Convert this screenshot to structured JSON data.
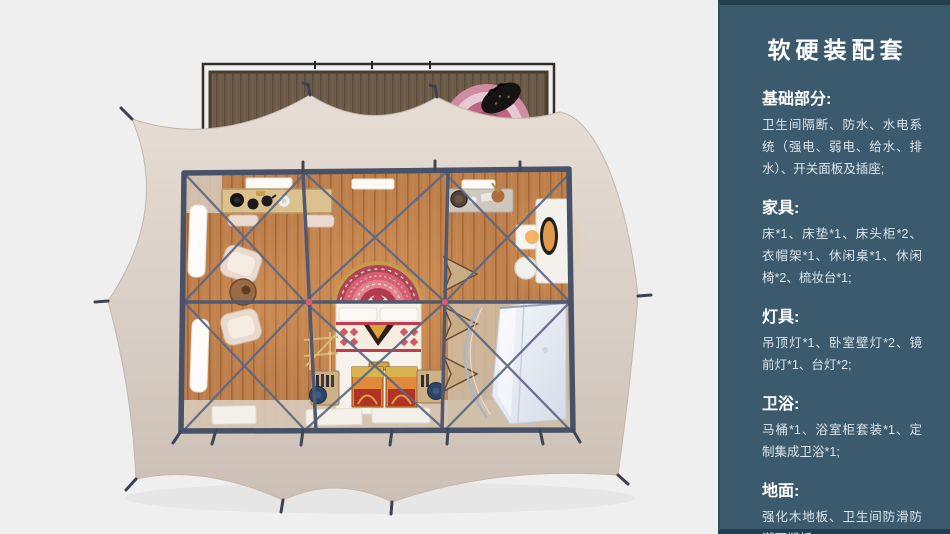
{
  "page": {
    "background": "#efeff0"
  },
  "sidebar": {
    "title": "软硬装配套",
    "sections": [
      {
        "heading": "基础部分:",
        "body": "卫生间隔断、防水、水电系统（强电、弱电、给水、排水）、开关面板及插座;"
      },
      {
        "heading": "家具:",
        "body": "床*1、床垫*1、床头柜*2、衣帽架*1、休闲桌*1、休闲椅*2、梳妆台*1;"
      },
      {
        "heading": "灯具:",
        "body": "吊顶灯*1、卧室壁灯*2、镜前灯*1、台灯*2;"
      },
      {
        "heading": "卫浴:",
        "body": "马桶*1、浴室柜套装*1、定制集成卫浴*1;"
      },
      {
        "heading": "地面:",
        "body": "强化木地板、卫生间防滑防潮石塑板;"
      }
    ],
    "colors": {
      "background": "#3c5a6d",
      "edge": "#24404e",
      "heading_text": "#ffffff",
      "body_text": "#dbe5ec"
    }
  },
  "floorplan": {
    "colors": {
      "tent_canvas": "#d9cec5",
      "deck_wood": "#6d5c4a",
      "floor_wood": "#bd7f4c",
      "steel_frame": "#4f5a72",
      "rug_red": "#d25f70",
      "bed_linen": "#f5f2ec",
      "chest_orange": "#e08a3a",
      "bathroom_pod": "#e6ebf3",
      "joint_red": "#e15b66"
    },
    "elements": [
      "wood-deck",
      "deck-rug",
      "travel-bag",
      "tent-canvas",
      "tent-stakes",
      "steel-frame",
      "roof-windows",
      "wall-windows",
      "console-table",
      "tea-table",
      "lounge-chairs",
      "side-table",
      "bed",
      "bedside-rug",
      "foot-chests",
      "bottle-racks",
      "coat-rack",
      "folding-screen",
      "vanity",
      "bathroom-pod",
      "shower-screen",
      "door-mats"
    ]
  }
}
